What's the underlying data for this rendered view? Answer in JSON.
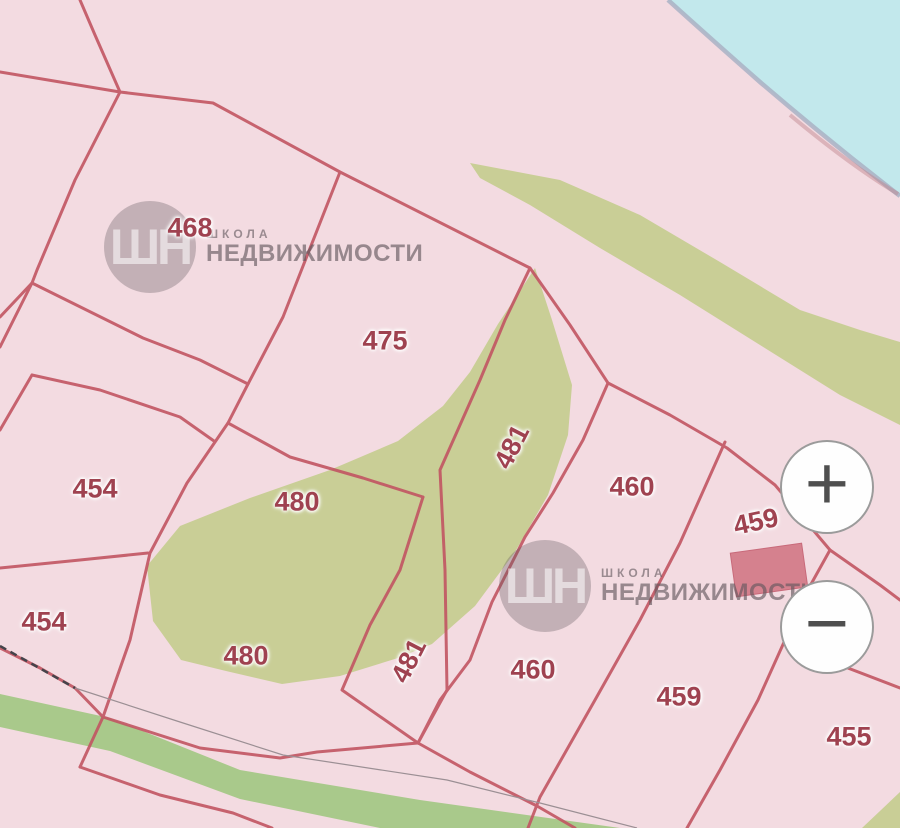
{
  "map": {
    "description": "cadastral parcel map",
    "parcel_labels": [
      {
        "text": "468",
        "x": 190,
        "y": 228,
        "rotation": 0
      },
      {
        "text": "475",
        "x": 385,
        "y": 341,
        "rotation": 0
      },
      {
        "text": "454",
        "x": 95,
        "y": 489,
        "rotation": 0
      },
      {
        "text": "454",
        "x": 44,
        "y": 622,
        "rotation": 0
      },
      {
        "text": "480",
        "x": 297,
        "y": 502,
        "rotation": 0
      },
      {
        "text": "480",
        "x": 246,
        "y": 656,
        "rotation": 0
      },
      {
        "text": "481",
        "x": 512,
        "y": 447,
        "rotation": -63
      },
      {
        "text": "481",
        "x": 409,
        "y": 661,
        "rotation": -63
      },
      {
        "text": "460",
        "x": 632,
        "y": 487,
        "rotation": 0
      },
      {
        "text": "460",
        "x": 533,
        "y": 670,
        "rotation": 0
      },
      {
        "text": "459",
        "x": 756,
        "y": 522,
        "rotation": -12
      },
      {
        "text": "459",
        "x": 679,
        "y": 697,
        "rotation": 0
      },
      {
        "text": "455",
        "x": 849,
        "y": 737,
        "rotation": 0
      }
    ],
    "colors": {
      "land_pink": "#f3dbe1",
      "water_cyan": "#c2e8ec",
      "shoreline_gray": "#a9b2c4",
      "vegetation_olive": "#c9ce96",
      "road_green": "#a9c98b",
      "boundary_red": "#c25562",
      "label_red": "#9f4250",
      "building_red": "#d5818e"
    }
  },
  "watermark": {
    "logo": "ШН",
    "line1": "ШКОЛА",
    "line2": "НЕДВИЖИМОСТИ",
    "positions": [
      {
        "x": 104,
        "y": 201
      },
      {
        "x": 499,
        "y": 540
      }
    ]
  },
  "controls": {
    "zoom_in_label": "+",
    "zoom_out_label": "−"
  }
}
